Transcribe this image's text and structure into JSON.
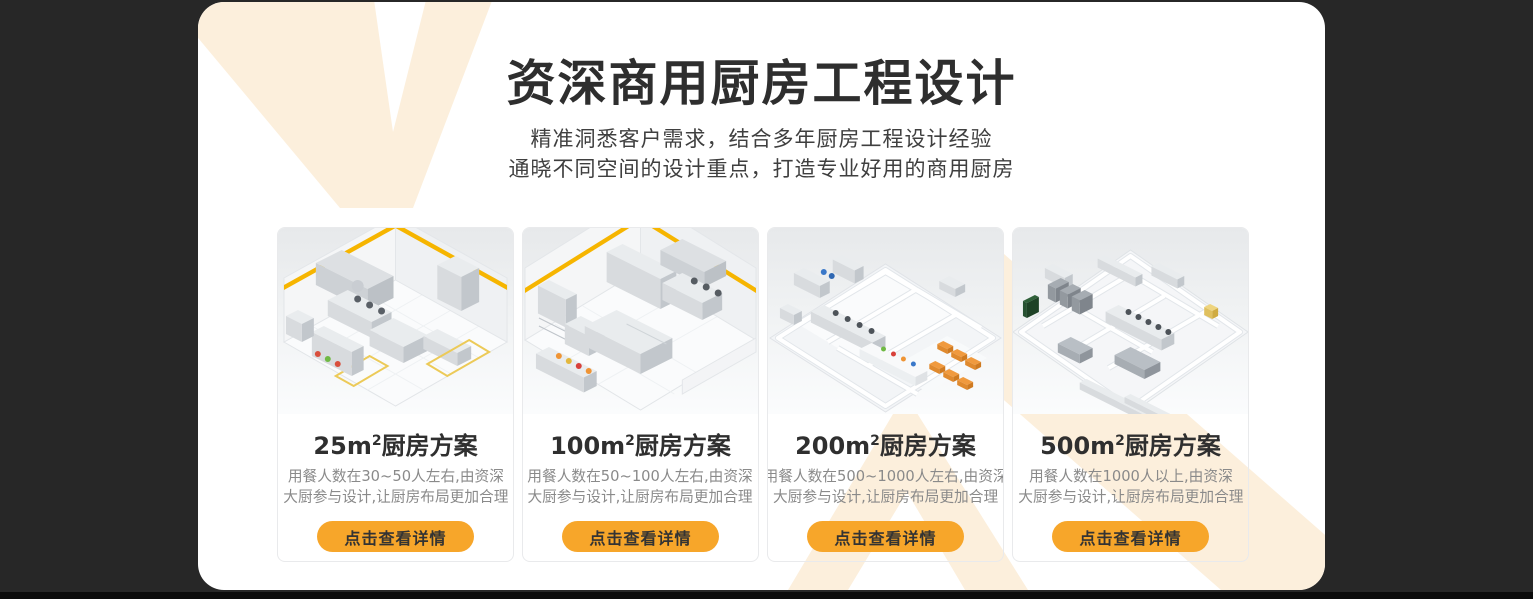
{
  "colors": {
    "background": "#272727",
    "panel": "#ffffff",
    "accent_orange": "#F7A62A",
    "decor_cream": "#FCEFDC",
    "title_text": "#2e2e2e",
    "body_text": "#3f3f3f",
    "muted_text": "#8a8a8a"
  },
  "header": {
    "title": "资深商用厨房工程设计",
    "subtitle_line1": "精准洞悉客户需求，结合多年厨房工程设计经验",
    "subtitle_line2": "通晓不同空间的设计重点，打造专业好用的商用厨房"
  },
  "cards": [
    {
      "area": "25m",
      "area_sup": "2",
      "title_suffix": "厨房方案",
      "desc_line1": "用餐人数在30~50人左右,由资深",
      "desc_line2": "大厨参与设计,让厨房布局更加合理",
      "button_label": "点击查看详情"
    },
    {
      "area": "100m",
      "area_sup": "2",
      "title_suffix": "厨房方案",
      "desc_line1": "用餐人数在50~100人左右,由资深",
      "desc_line2": "大厨参与设计,让厨房布局更加合理",
      "button_label": "点击查看详情"
    },
    {
      "area": "200m",
      "area_sup": "2",
      "title_suffix": "厨房方案",
      "desc_line1": "用餐人数在500~1000人左右,由资深",
      "desc_line2": "大厨参与设计,让厨房布局更加合理",
      "button_label": "点击查看详情"
    },
    {
      "area": "500m",
      "area_sup": "2",
      "title_suffix": "厨房方案",
      "desc_line1": "用餐人数在1000人以上,由资深",
      "desc_line2": "大厨参与设计,让厨房布局更加合理",
      "button_label": "点击查看详情"
    }
  ]
}
